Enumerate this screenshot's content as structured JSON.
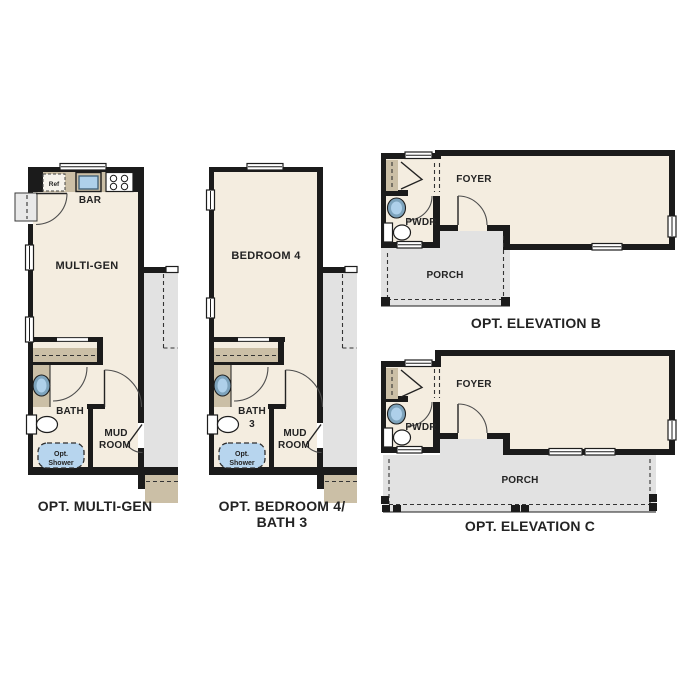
{
  "palette": {
    "wall": "#1b1b1b",
    "floor": "#f4ede0",
    "tan": "#cbbfa6",
    "gray": "#e2e2e2",
    "gray_light": "#e9e9e9",
    "blue": "#aed0ea",
    "blue_dark": "#7da3bc",
    "shower_blue": "#b7d5ee",
    "text": "#232323"
  },
  "plans": {
    "multigen": {
      "caption": "OPT. MULTI-GEN",
      "rooms": {
        "main": "MULTI-GEN",
        "bar": "BAR",
        "bath": "BATH",
        "mud_line1": "MUD",
        "mud_line2": "ROOM"
      },
      "fixtures": {
        "ref": "Ref",
        "shower_line1": "Opt.",
        "shower_line2": "Shower"
      }
    },
    "bedroom4": {
      "caption_line1": "OPT. BEDROOM 4/",
      "caption_line2": "BATH 3",
      "rooms": {
        "main": "BEDROOM 4",
        "bath_line1": "BATH",
        "bath_line2": "3",
        "mud_line1": "MUD",
        "mud_line2": "ROOM"
      },
      "fixtures": {
        "shower_line1": "Opt.",
        "shower_line2": "Shower"
      }
    },
    "elevation_b": {
      "caption": "OPT. ELEVATION B",
      "rooms": {
        "foyer": "FOYER",
        "pwdr": "PWDR",
        "porch": "PORCH"
      }
    },
    "elevation_c": {
      "caption": "OPT. ELEVATION C",
      "rooms": {
        "foyer": "FOYER",
        "pwdr": "PWDR",
        "porch": "PORCH"
      }
    }
  }
}
